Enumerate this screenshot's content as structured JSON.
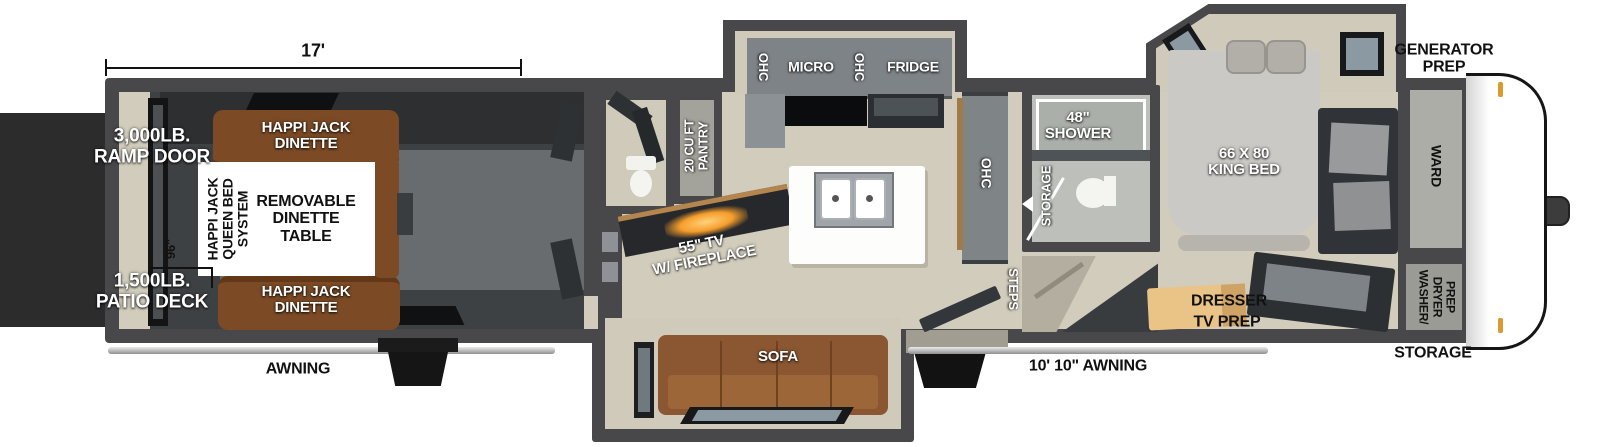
{
  "labels": {
    "dim_17": "17'",
    "dim_96": "96\"",
    "ramp_door": "3,000LB.\nRAMP DOOR",
    "patio_deck": "1,500LB.\nPATIO DECK",
    "awning_rear": "AWNING",
    "awning_main": "10' 10\" AWNING",
    "dinette_top": "HAPPI JACK\nDINETTE",
    "dinette_bottom": "HAPPI JACK\nDINETTE",
    "queen_bed_system": "HAPPI JACK\nQUEEN BED\nSYSTEM",
    "removable_table": "REMOVABLE\nDINETTE\nTABLE",
    "pantry": "20 CU FT\nPANTRY",
    "tv_fireplace": "55\" TV\nW/ FIREPLACE",
    "kitchen_ohc_left": "OHC",
    "kitchen_micro": "MICRO",
    "kitchen_ohc_right": "OHC",
    "kitchen_fridge": "FRIDGE",
    "sofa": "SOFA",
    "ohc_wall": "OHC",
    "steps": "STEPS",
    "shower": "48\"\nSHOWER",
    "bath_storage": "STORAGE",
    "king_bed": "66 X 80\nKING BED",
    "dresser": "DRESSER",
    "tv_prep": "TV PREP",
    "generator_prep": "GENERATOR\nPREP",
    "ward": "WARD",
    "wd_line1": "WASHER/",
    "wd_line2": "DRYER",
    "wd_line3": "PREP",
    "storage_front": "STORAGE"
  },
  "colors": {
    "wall": "#48484a",
    "floor_beige": "#d1ccbc",
    "garage_floor": "#3e4144",
    "wood_brown": "#8a5732",
    "appliance_gray": "#7e8387",
    "backdrop_dark": "#2c2c2c",
    "dresser_tan": "#eac487",
    "fireplace_glow": "#f59d2b",
    "marker_light": "#d99a2f",
    "window_glass": "#8b99a3"
  }
}
